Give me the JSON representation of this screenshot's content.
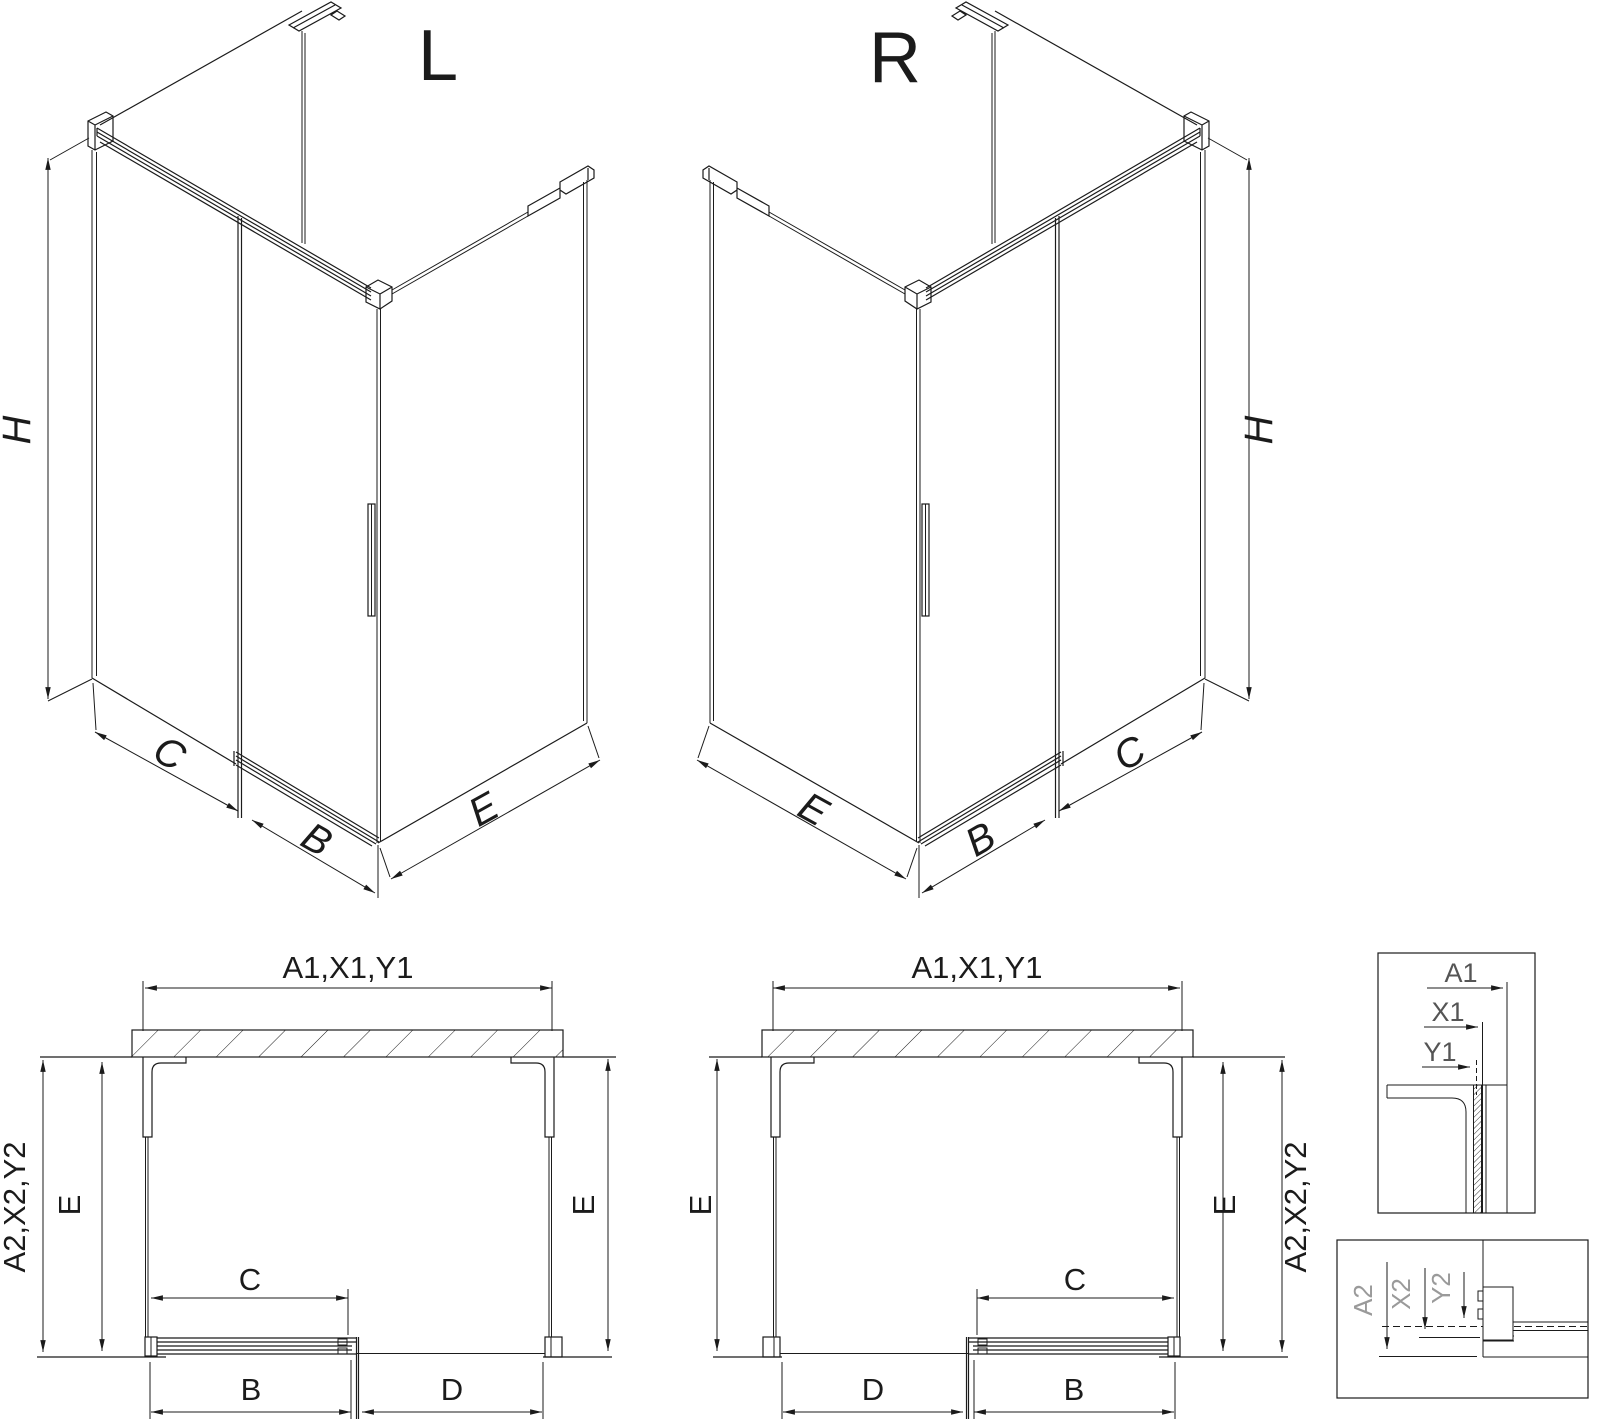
{
  "iso_left": {
    "view_label": "L",
    "dim_h": "H",
    "dim_c": "C",
    "dim_b": "B",
    "dim_e": "E"
  },
  "iso_right": {
    "view_label": "R",
    "dim_h": "H",
    "dim_c": "C",
    "dim_b": "B",
    "dim_e": "E"
  },
  "plan_left": {
    "dim_top": "A1,X1,Y1",
    "dim_side": "A2,X2,Y2",
    "dim_e_left": "E",
    "dim_e_right": "E",
    "dim_c": "C",
    "dim_b": "B",
    "dim_d": "D"
  },
  "plan_right": {
    "dim_top": "A1,X1,Y1",
    "dim_side": "A2,X2,Y2",
    "dim_e_left": "E",
    "dim_e_right": "E",
    "dim_c": "C",
    "dim_b": "B",
    "dim_d": "D"
  },
  "detail_top": {
    "dim_a1": "A1",
    "dim_x1": "X1",
    "dim_y1": "Y1"
  },
  "detail_bottom": {
    "dim_a2": "A2",
    "dim_x2": "X2",
    "dim_y2": "Y2"
  },
  "colors": {
    "line": "#1b1b1b",
    "muted": "#9a9a9a",
    "detail_label": "#555555",
    "background": "#ffffff"
  }
}
